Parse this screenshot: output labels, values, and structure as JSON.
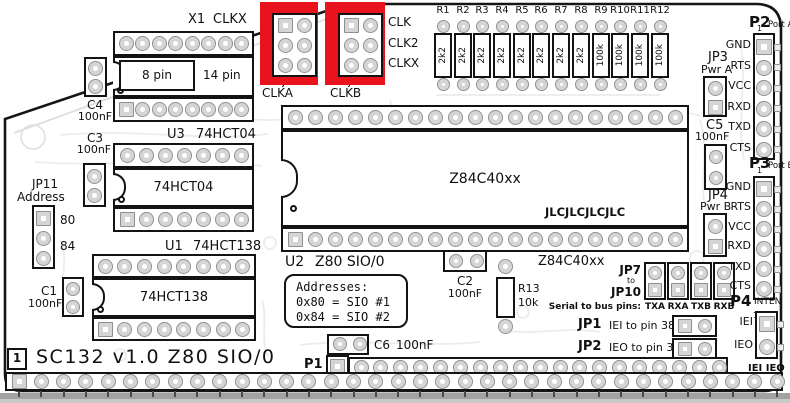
{
  "board": {
    "title": "SC132 v1.0 Z80 SIO/0",
    "corner_marker": "1",
    "fab_logo": "JLCJLCJLCJLC"
  },
  "highlight": {
    "color": "#e8131d"
  },
  "components": {
    "x1": {
      "ref": "X1",
      "signal": "CLKX",
      "inner_left": "8 pin",
      "inner_right": "14 pin"
    },
    "c4": {
      "ref": "C4",
      "value": "100nF"
    },
    "u3": {
      "ref": "U3",
      "part": "74HCT04",
      "chip_text": "74HCT04"
    },
    "c3": {
      "ref": "C3",
      "value": "100nF"
    },
    "jp11": {
      "ref": "JP11",
      "label": "Address",
      "option_top": "80",
      "option_bottom": "84"
    },
    "u1": {
      "ref": "U1",
      "part": "74HCT138",
      "chip_text": "74HCT138"
    },
    "c1": {
      "ref": "C1",
      "value": "100nF"
    },
    "u2": {
      "ref": "U2",
      "part": "Z80 SIO/0",
      "chip_text": "Z84C40xx",
      "part_right": "Z84C40xx"
    },
    "c2": {
      "ref": "C2",
      "value": "100nF"
    },
    "r13": {
      "ref": "R13",
      "value": "10k"
    },
    "c5": {
      "ref": "C5",
      "value": "100nF"
    },
    "c6": {
      "ref": "C6",
      "value": "100nF"
    },
    "jp3": {
      "ref": "JP3",
      "label": "Pwr A"
    },
    "jp4": {
      "ref": "JP4",
      "label": "Pwr B"
    },
    "jp5": {
      "ref": "JP5",
      "label": "CLKA"
    },
    "jp6": {
      "ref": "JP6",
      "label": "CLKB"
    }
  },
  "clock_pins": {
    "labels": [
      "CLK",
      "CLK2",
      "CLKX"
    ]
  },
  "resistors": {
    "refs": [
      "R1",
      "R2",
      "R3",
      "R4",
      "R5",
      "R6",
      "R7",
      "R8",
      "R9",
      "R10",
      "R11",
      "R12"
    ],
    "values": [
      "2k2",
      "2k2",
      "2k2",
      "2k2",
      "2k2",
      "2k2",
      "2k2",
      "2k2",
      "100k",
      "100k",
      "100k",
      "100k"
    ]
  },
  "addresses": {
    "heading": "Addresses:",
    "line1": "0x80 = SIO #1",
    "line2": "0x84 = SIO #2"
  },
  "serial_jumpers": {
    "from": "JP7",
    "to_word": "to",
    "to": "JP10",
    "note": "Serial to bus pins:",
    "columns": [
      "TXA",
      "RXA",
      "TXB",
      "RXB"
    ]
  },
  "int_jumpers": {
    "jp1": {
      "ref": "JP1",
      "desc": "IEI to pin 38"
    },
    "jp2": {
      "ref": "JP2",
      "desc": "IEO to pin 39"
    }
  },
  "headers": {
    "p1": {
      "ref": "P1"
    },
    "p2": {
      "ref": "P2",
      "name": "Port A",
      "pin1": "1",
      "pins": [
        "GND",
        "RTS",
        "VCC",
        "RXD",
        "TXD",
        "CTS"
      ]
    },
    "p3": {
      "ref": "P3",
      "name": "Port B",
      "pin1": "1",
      "pins": [
        "GND",
        "RTS",
        "VCC",
        "RXD",
        "TXD",
        "CTS"
      ]
    },
    "p4": {
      "ref": "P4",
      "name": "INTEN",
      "pin1": "1",
      "pin_iei": "IEI",
      "pin_ieo": "IEO",
      "footer": "IEI IEO"
    }
  }
}
